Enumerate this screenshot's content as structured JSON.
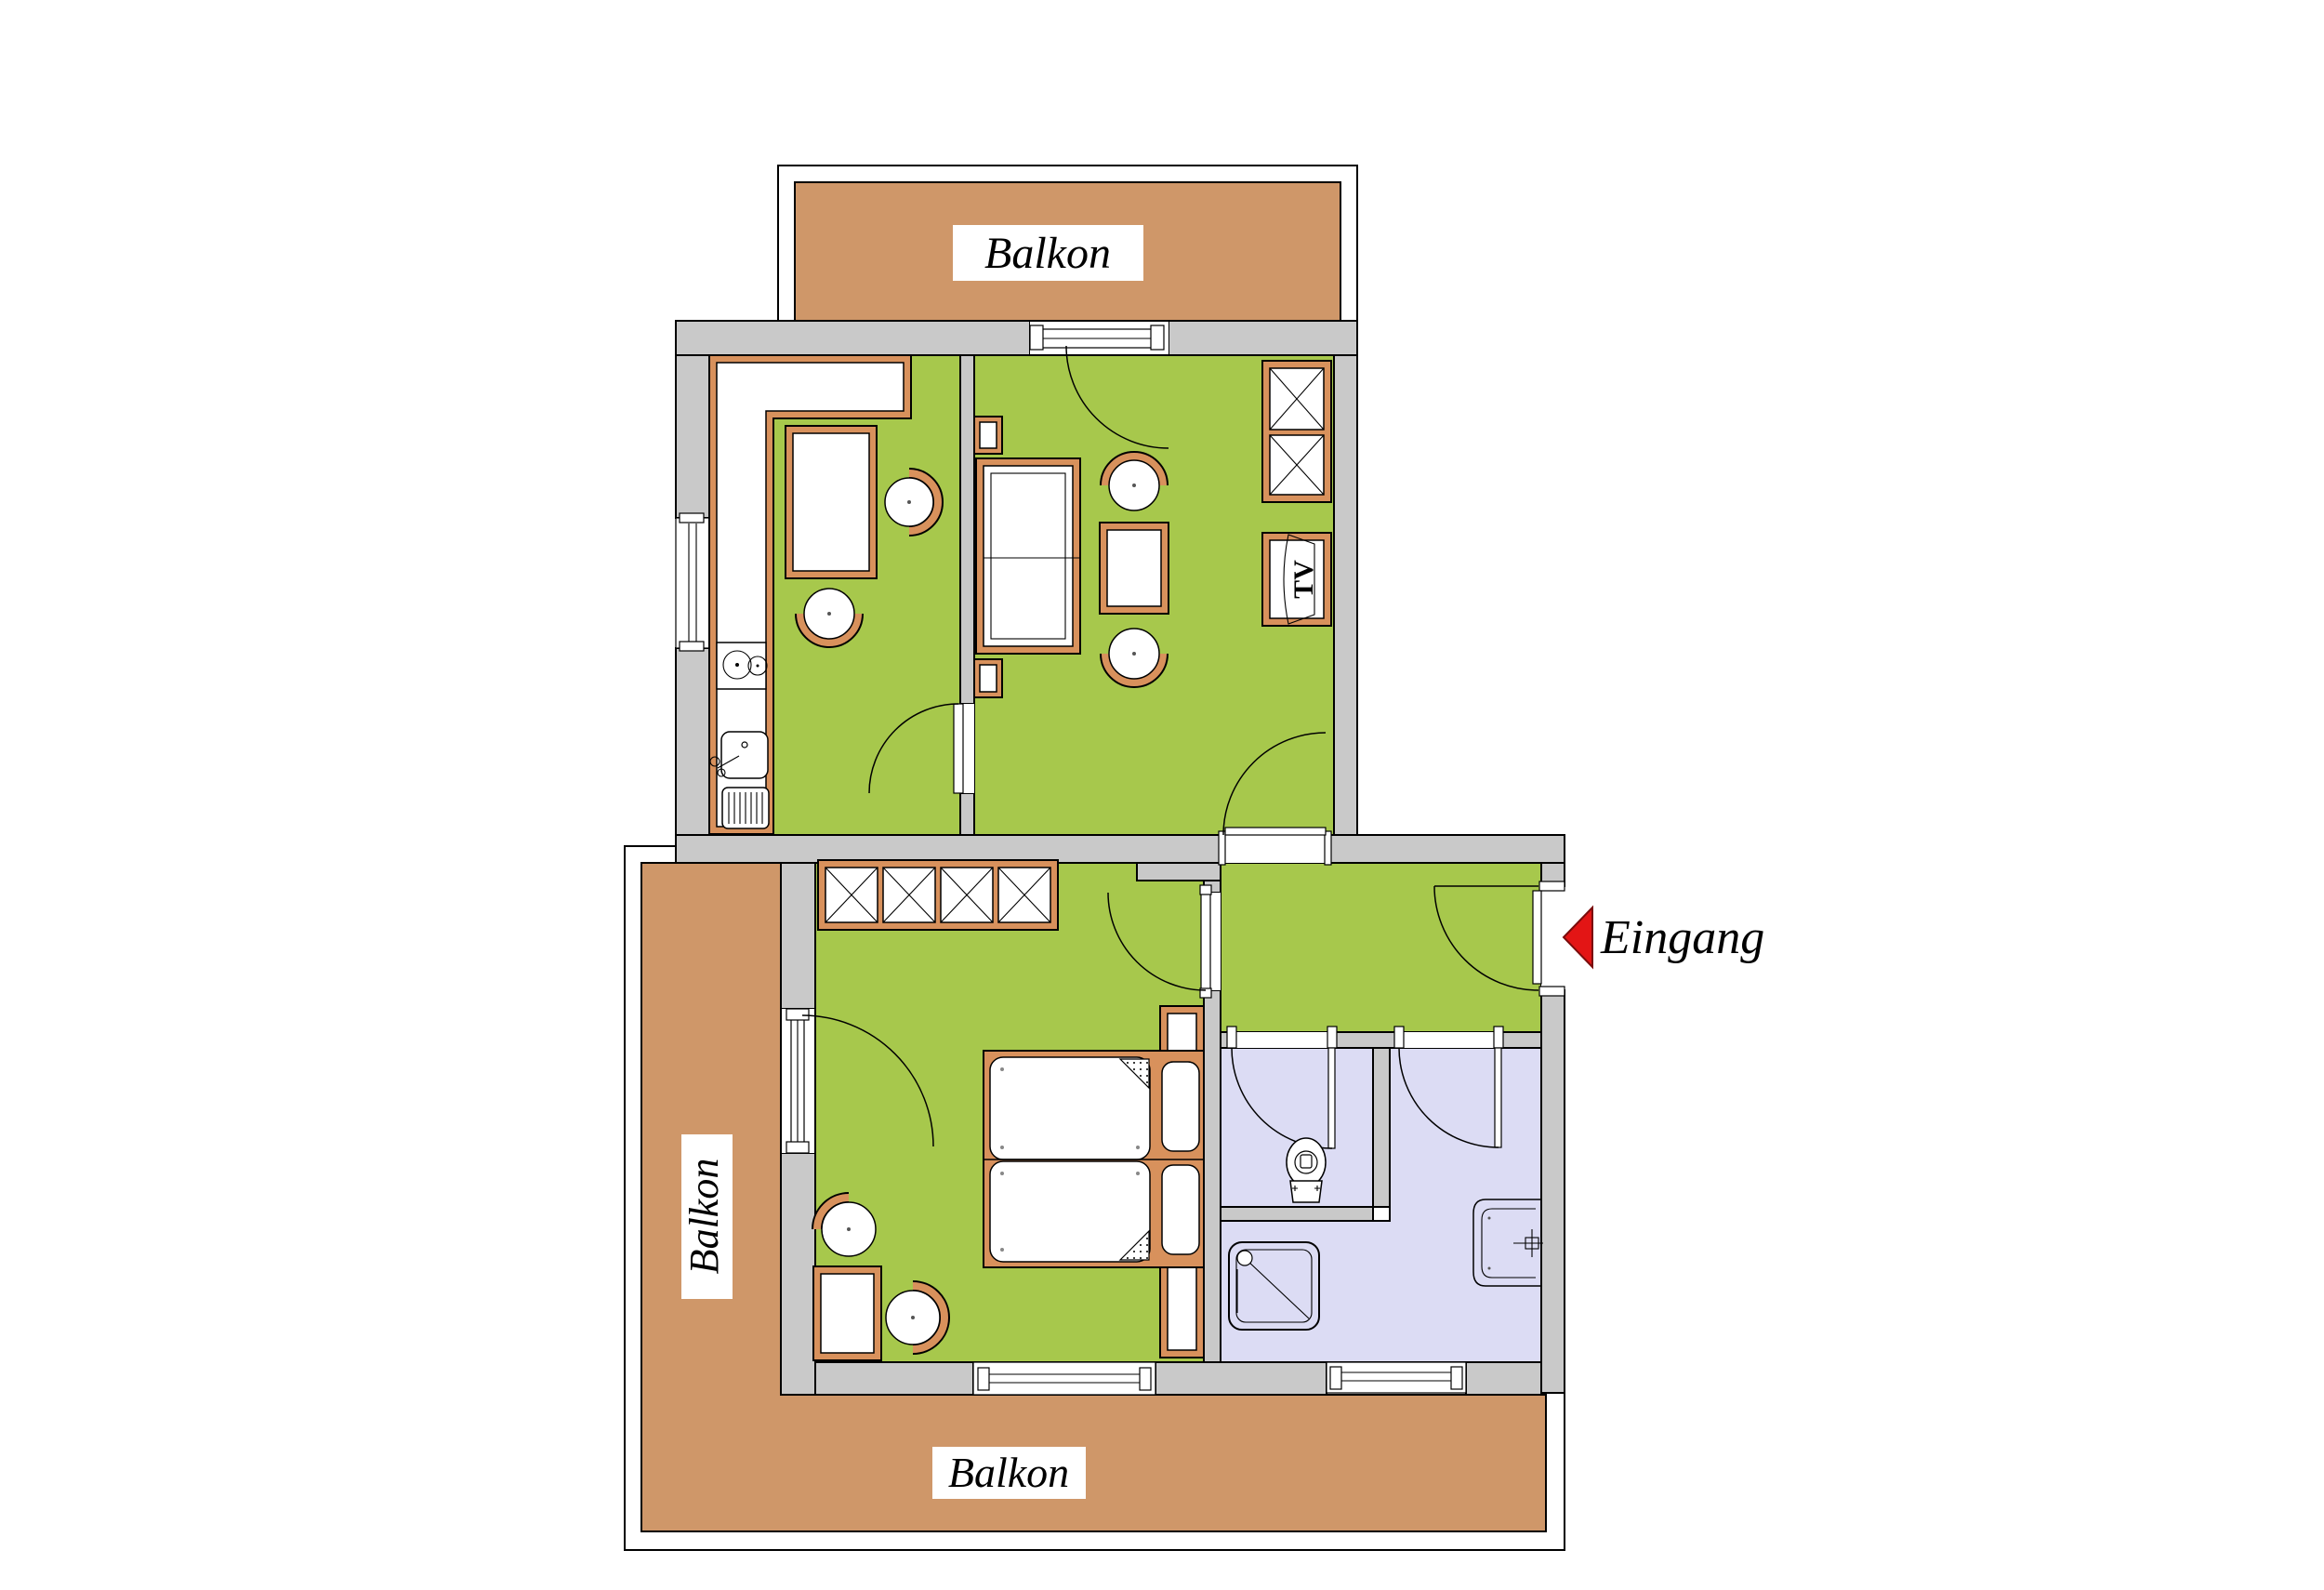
{
  "floorplan": {
    "labels": {
      "balcony_top": "Balkon",
      "balcony_left": "Balkon",
      "balcony_bottom": "Balkon",
      "entrance": "Eingang",
      "tv_cabinet": "TV"
    },
    "entrance_arrow_icon": "left-pointing-triangle",
    "colors": {
      "room_green": "#a7c84c",
      "balcony_brown": "#cf9769",
      "bath_lavender": "#dcdcf4",
      "wall_gray": "#c9c9c9",
      "furniture_orange": "#d8915c",
      "arrow_red": "#e31515",
      "line_black": "#000000"
    }
  }
}
